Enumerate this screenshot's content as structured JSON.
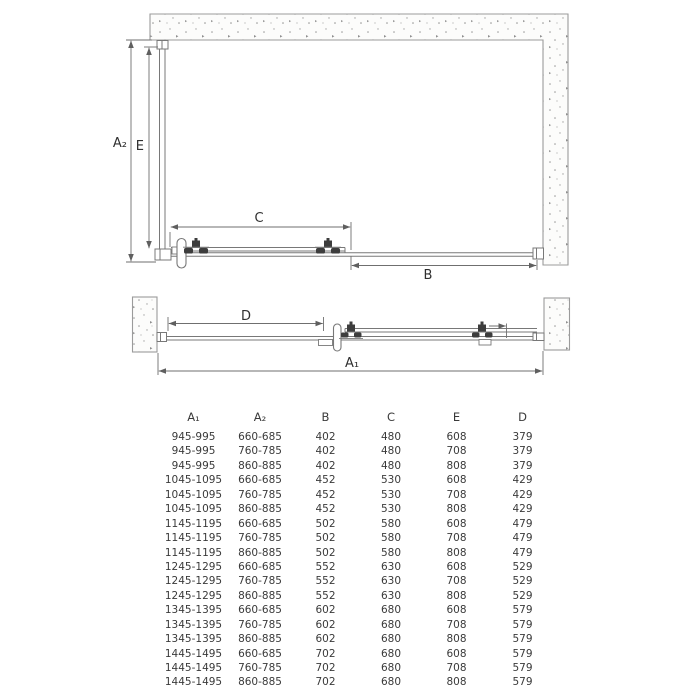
{
  "front_view": {
    "labels": {
      "a2": "A₂",
      "e": "E",
      "c": "C",
      "b": "B"
    }
  },
  "plan_view": {
    "labels": {
      "d": "D",
      "a1": "A₁"
    }
  },
  "table": {
    "columns": [
      "A₁",
      "A₂",
      "B",
      "C",
      "E",
      "D"
    ],
    "rows": [
      [
        "945-995",
        "660-685",
        "402",
        "480",
        "608",
        "379"
      ],
      [
        "945-995",
        "760-785",
        "402",
        "480",
        "708",
        "379"
      ],
      [
        "945-995",
        "860-885",
        "402",
        "480",
        "808",
        "379"
      ],
      [
        "1045-1095",
        "660-685",
        "452",
        "530",
        "608",
        "429"
      ],
      [
        "1045-1095",
        "760-785",
        "452",
        "530",
        "708",
        "429"
      ],
      [
        "1045-1095",
        "860-885",
        "452",
        "530",
        "808",
        "429"
      ],
      [
        "1145-1195",
        "660-685",
        "502",
        "580",
        "608",
        "479"
      ],
      [
        "1145-1195",
        "760-785",
        "502",
        "580",
        "708",
        "479"
      ],
      [
        "1145-1195",
        "860-885",
        "502",
        "580",
        "808",
        "479"
      ],
      [
        "1245-1295",
        "660-685",
        "552",
        "630",
        "608",
        "529"
      ],
      [
        "1245-1295",
        "760-785",
        "552",
        "630",
        "708",
        "529"
      ],
      [
        "1245-1295",
        "860-885",
        "552",
        "630",
        "808",
        "529"
      ],
      [
        "1345-1395",
        "660-685",
        "602",
        "680",
        "608",
        "579"
      ],
      [
        "1345-1395",
        "760-785",
        "602",
        "680",
        "708",
        "579"
      ],
      [
        "1345-1395",
        "860-885",
        "602",
        "680",
        "808",
        "579"
      ],
      [
        "1445-1495",
        "660-685",
        "702",
        "680",
        "608",
        "579"
      ],
      [
        "1445-1495",
        "760-785",
        "702",
        "680",
        "708",
        "579"
      ],
      [
        "1445-1495",
        "860-885",
        "702",
        "680",
        "808",
        "579"
      ]
    ]
  },
  "colors": {
    "line": "#787878",
    "dim_line": "#6f6f6f",
    "wall_stroke": "#9b9b9b",
    "dark_hardware": "#3d3d3d",
    "text": "#3a3a3a",
    "background": "#ffffff"
  }
}
